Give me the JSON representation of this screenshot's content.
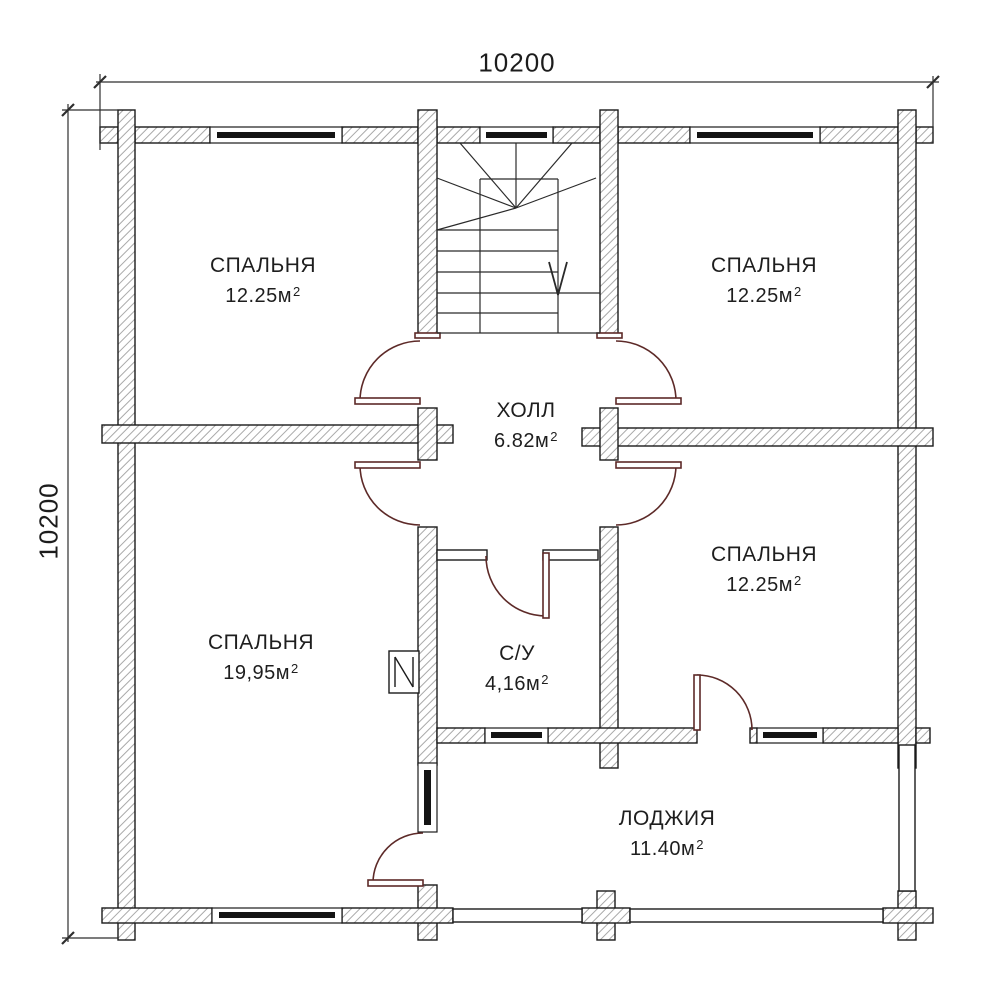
{
  "drawing": {
    "type": "floor-plan-second-storey",
    "dimensions": {
      "top": "10200",
      "left": "10200"
    },
    "rooms": [
      {
        "id": "bedroom-top-left",
        "name": "СПАЛЬНЯ",
        "area": "12.25м",
        "sup": "2"
      },
      {
        "id": "bedroom-top-right",
        "name": "СПАЛЬНЯ",
        "area": "12.25м",
        "sup": "2"
      },
      {
        "id": "hall",
        "name": "ХОЛЛ",
        "area": "6.82м",
        "sup": "2"
      },
      {
        "id": "bedroom-mid-right",
        "name": "СПАЛЬНЯ",
        "area": "12.25м",
        "sup": "2"
      },
      {
        "id": "bedroom-bottom-left",
        "name": "СПАЛЬНЯ",
        "area": "19,95м",
        "sup": "2"
      },
      {
        "id": "bathroom",
        "name": "С/У",
        "area": "4,16м",
        "sup": "2"
      },
      {
        "id": "loggia",
        "name": "ЛОДЖИЯ",
        "area": "11.40м",
        "sup": "2"
      }
    ],
    "colors": {
      "background": "#ffffff",
      "wall_outline": "#1b1b1b",
      "wall_hatch": "#a9a9a9",
      "window_glass": "#141414",
      "door_swing": "#5d2a28",
      "stairs_line": "#2a2a2a",
      "dimension_line": "#2e2e2e",
      "text": "#1e1e1e"
    }
  }
}
